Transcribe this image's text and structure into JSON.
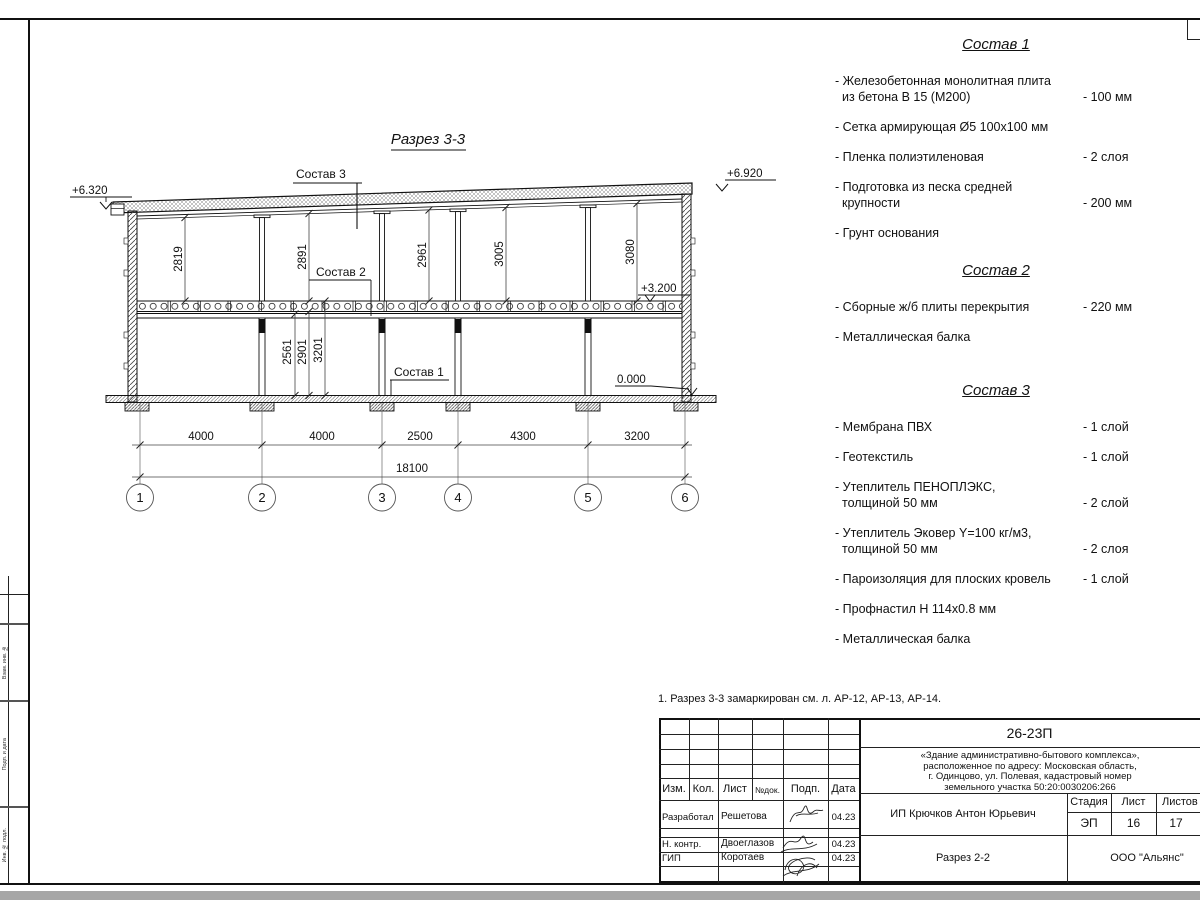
{
  "page": {
    "drawing_title": "Разрез 3-3",
    "note": "1. Разрез 3-3 замаркирован см. л. АР-12, АР-13, АР-14."
  },
  "section": {
    "callouts": {
      "c1": "Состав 1",
      "c2": "Состав 2",
      "c3": "Состав 3"
    },
    "elevations": {
      "roof_left": "+6.320",
      "roof_right": "+6.920",
      "floor2": "+3.200",
      "ground": "0.000"
    },
    "upper_dims": [
      "2819",
      "2891",
      "2961",
      "3005",
      "3080"
    ],
    "lower_dims": [
      "2561",
      "2901",
      "3201"
    ],
    "span_dims": [
      "4000",
      "4000",
      "2500",
      "4300",
      "3200"
    ],
    "total_span": "18100",
    "axes": [
      "1",
      "2",
      "3",
      "4",
      "5",
      "6"
    ]
  },
  "specs": [
    {
      "title": "Состав 1",
      "items": [
        {
          "line1": "- Железобетонная  монолитная плита",
          "line2": "из бетона В 15 (М200)",
          "value": "- 100 мм"
        },
        {
          "line1": "- Сетка армирующая Ø5 100х100 мм",
          "line2": "",
          "value": ""
        },
        {
          "line1": "- Пленка полиэтиленовая",
          "line2": "",
          "value": "-  2 слоя"
        },
        {
          "line1": "- Подготовка из песка средней",
          "line2": "крупности",
          "value": "- 200 мм"
        },
        {
          "line1": "- Грунт основания",
          "line2": "",
          "value": ""
        }
      ]
    },
    {
      "title": "Состав 2",
      "items": [
        {
          "line1": "- Сборные ж/б плиты перекрытия",
          "line2": "",
          "value": "- 220 мм"
        },
        {
          "line1": "- Металлическая балка",
          "line2": "",
          "value": ""
        }
      ]
    },
    {
      "title": "Состав 3",
      "items": [
        {
          "line1": "- Мембрана ПВХ",
          "line2": "",
          "value": "- 1 слой"
        },
        {
          "line1": "- Геотекстиль",
          "line2": "",
          "value": "- 1 слой"
        },
        {
          "line1": "- Утеплитель ПЕНОПЛЭКС,",
          "line2": "толщиной 50 мм",
          "value": "- 2 слой"
        },
        {
          "line1": "- Утеплитель Эковер Y=100 кг/м3,",
          "line2": "толщиной 50 мм",
          "value": "- 2 слоя"
        },
        {
          "line1": "- Пароизоляция для плоских кровель",
          "line2": "",
          "value": "- 1 слой"
        },
        {
          "line1": "- Профнастил Н 114х0.8 мм",
          "line2": "",
          "value": ""
        },
        {
          "line1": "- Металлическая балка",
          "line2": "",
          "value": ""
        }
      ]
    }
  ],
  "title_block": {
    "code": "26-23П",
    "object_lines": [
      "«Здание административно-бытового комплекса»,",
      "расположенное по адресу: Московская область,",
      "г. Одинцово, ул. Полевая, кадастровый номер",
      "земельного участка 50:20:0030206:266"
    ],
    "columns": {
      "izm": "Изм.",
      "kol": "Кол.",
      "list": "Лист",
      "ndoc": "№док.",
      "podp": "Подп.",
      "data": "Дата"
    },
    "stage_label": "Стадия",
    "sheet_label": "Лист",
    "sheets_label": "Листов",
    "stage": "ЭП",
    "sheet": "16",
    "sheets": "17",
    "rows": [
      {
        "role": "Разработал",
        "name": "Решетова",
        "date": "04.23"
      },
      {
        "role": "Н. контр.",
        "name": "Двоеглазов",
        "date": "04.23"
      },
      {
        "role": "ГИП",
        "name": "Коротаев",
        "date": "04.23"
      }
    ],
    "client": "ИП Крючков Антон Юрьевич",
    "sheet_title": "Разрез 2-2",
    "company": "ООО \"Альянс\""
  },
  "margin_labels": [
    "Взам. инв. №",
    "Подп. и дата",
    "Инв. № подл."
  ]
}
